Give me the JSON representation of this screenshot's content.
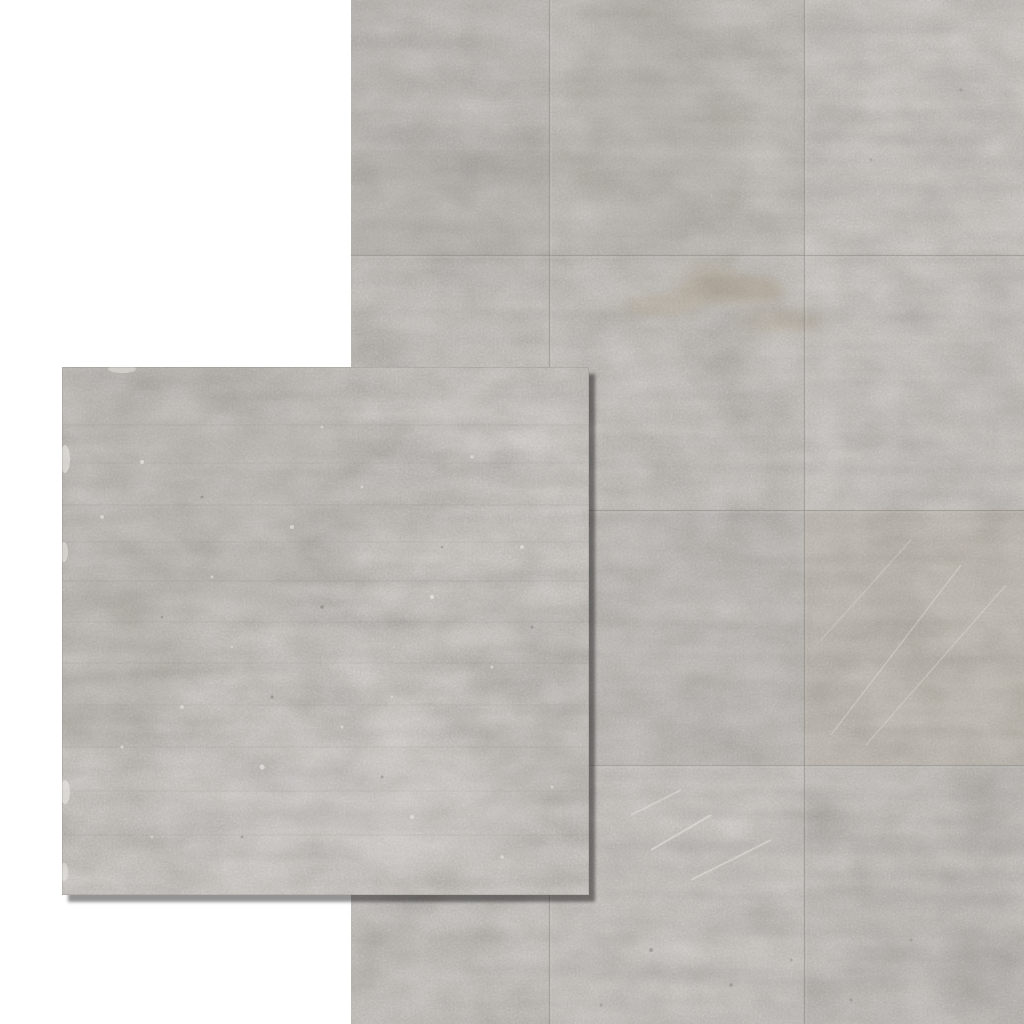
{
  "scene": {
    "kind": "product-photo",
    "subject": "Grey concrete-effect floor tiles: tiled room view with single tile swatch overlay",
    "canvas_background": "#ffffff"
  },
  "room_view": {
    "base_color": "#c0bcb7",
    "tile_columns": 3,
    "tile_rows": 4,
    "seam_dark": "#76726c",
    "seam_light": "#d8d5d0",
    "warm_accent": "#9c8a6a",
    "scratch_color": "#e9e6e1"
  },
  "swatch": {
    "base_color": "#c2beb9",
    "striation_color": "#6f6b66",
    "speckle_color": "#f2f0ec",
    "pore_color": "#6e6a65",
    "edge_color": "#5f5b56",
    "shadow_color": "rgba(0,0,0,0.42)"
  }
}
